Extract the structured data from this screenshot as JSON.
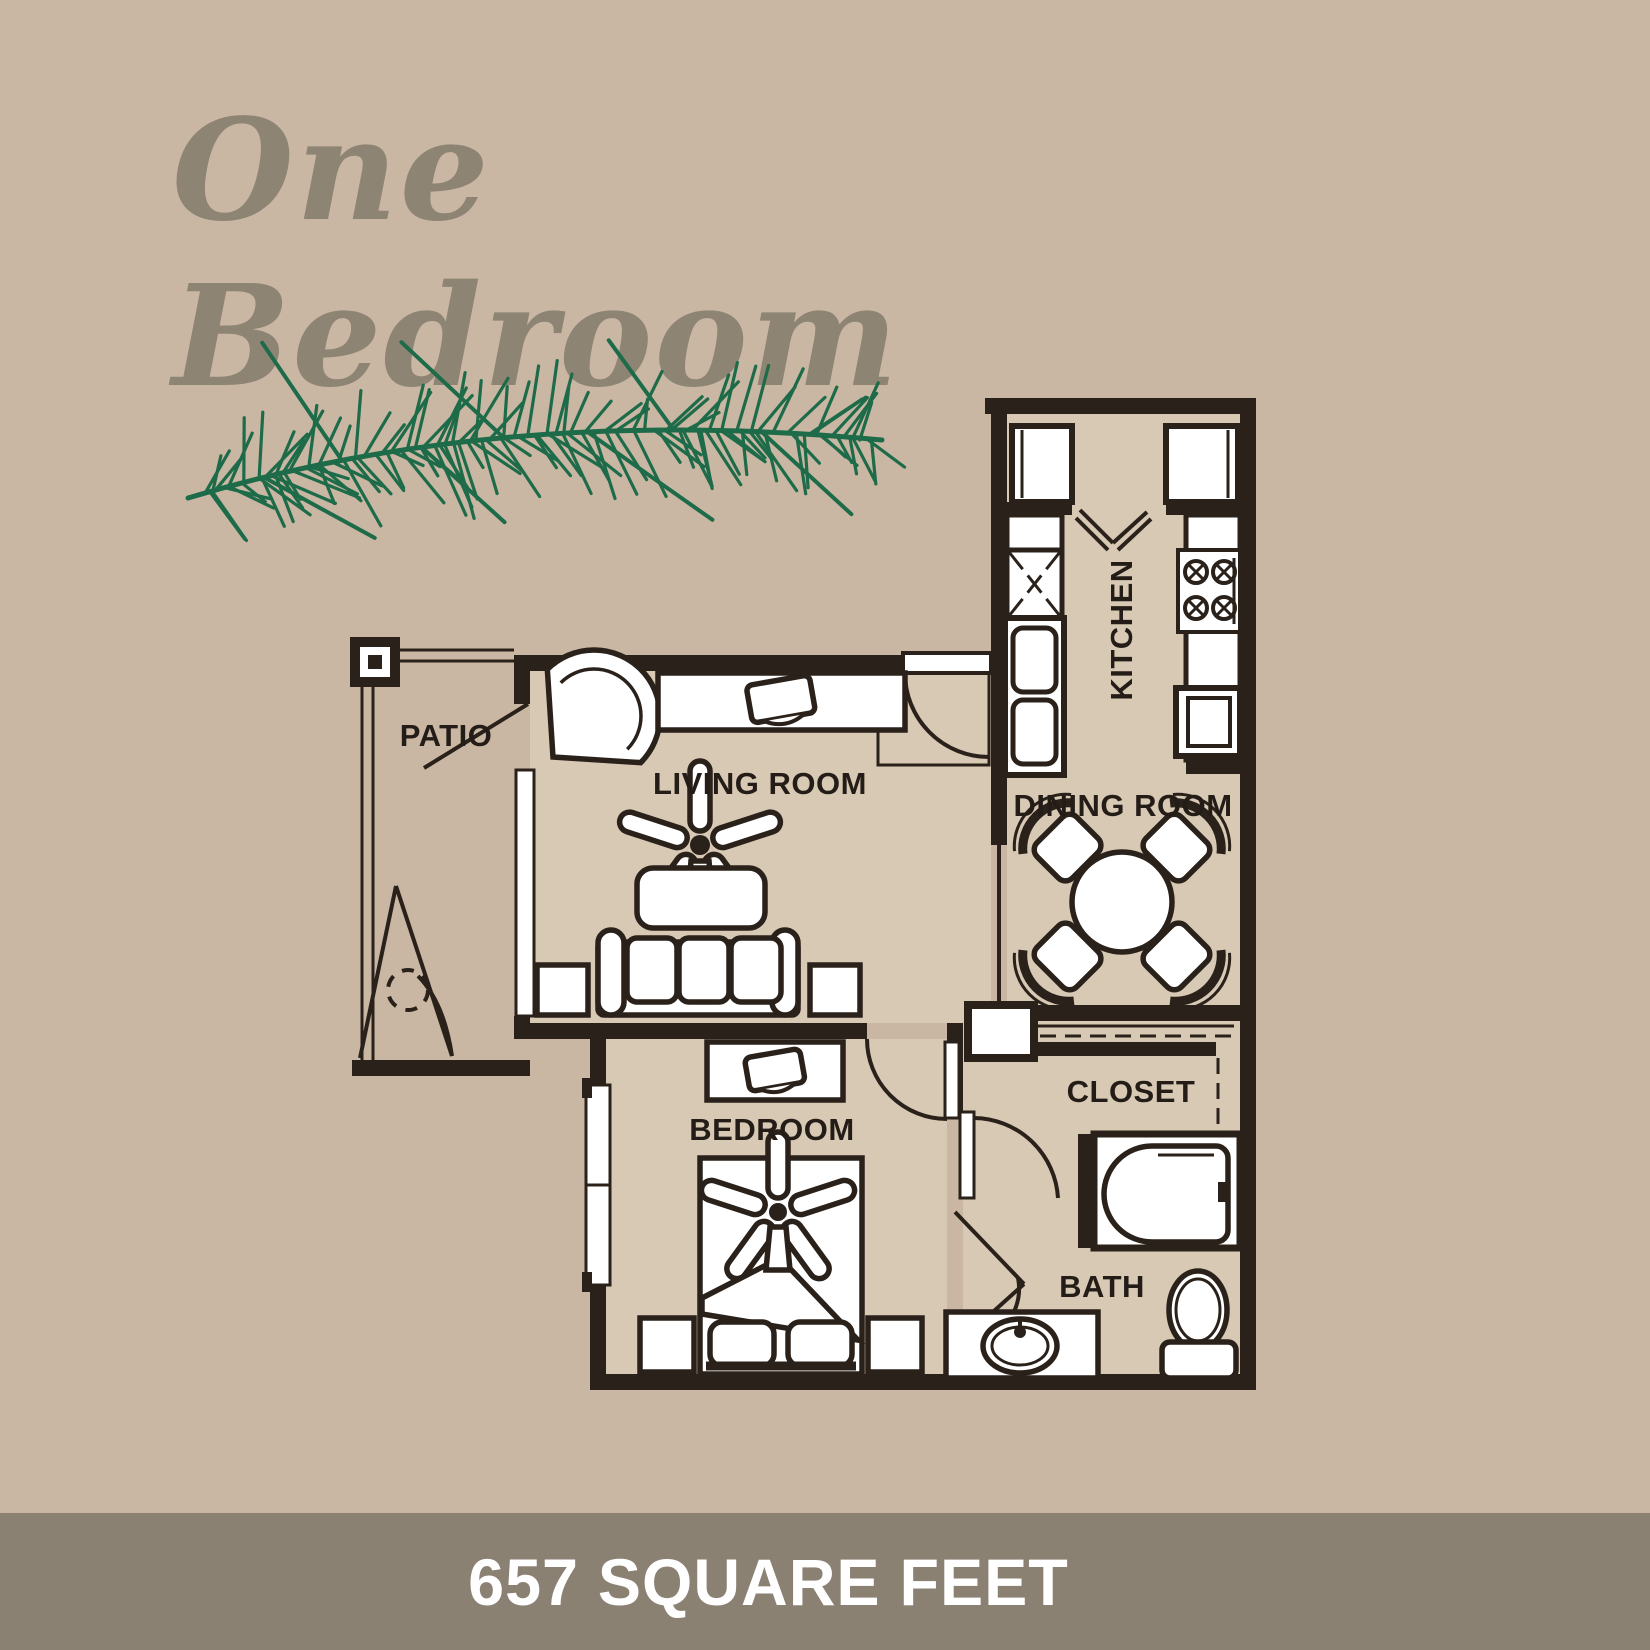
{
  "title": {
    "line1": "One",
    "line2": "Bedroom"
  },
  "plan": {
    "rooms": {
      "patio": "PATIO",
      "living_room": "LIVING ROOM",
      "kitchen": "KITCHEN",
      "dining_room": "DINING ROOM",
      "bedroom": "BEDROOM",
      "closet": "CLOSET",
      "bath": "BATH"
    },
    "fixtures": [
      "refrigerator",
      "pantry-cabinet",
      "double-sink",
      "stove",
      "dishwasher",
      "dining-table-with-four-chairs",
      "corner-chair",
      "tv-console",
      "ceiling-fan",
      "coffee-table",
      "sofa",
      "end-tables",
      "dresser",
      "bed-with-pillows",
      "nightstands",
      "bathtub",
      "toilet",
      "vanity-sink",
      "planter"
    ]
  },
  "footer": {
    "area_text": "657 SQUARE FEET"
  },
  "colors": {
    "background": "#c9b7a3",
    "room_fill": "#d8c9b4",
    "wall": "#2a211a",
    "title_text": "#8e8473",
    "footer_band": "#8a8173",
    "footer_text": "#ffffff",
    "pine_green": "#1e6b49"
  }
}
